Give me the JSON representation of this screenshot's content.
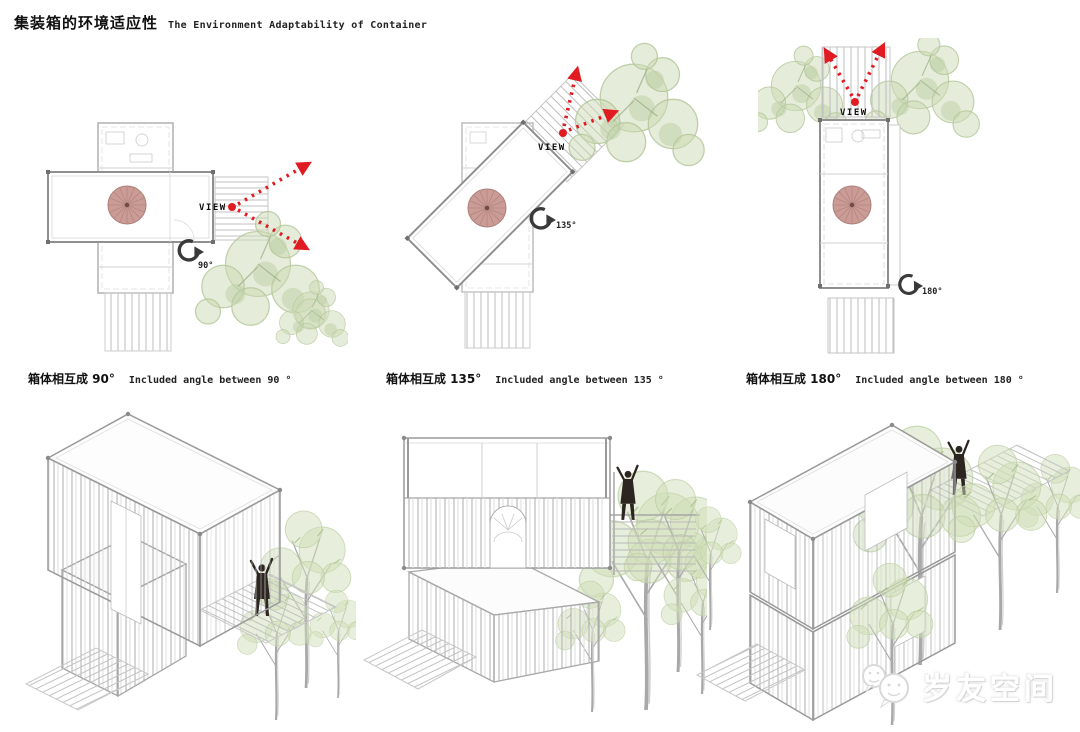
{
  "header": {
    "title_zh": "集装箱的环境适应性",
    "title_en": "The Environment Adaptability of Container"
  },
  "plans": [
    {
      "view_label": "VIEW",
      "angle_label": "90°",
      "caption_zh": "箱体相互成 90°",
      "caption_en": "Included angle between 90 °"
    },
    {
      "view_label": "VIEW",
      "angle_label": "135°",
      "caption_zh": "箱体相互成 135°",
      "caption_en": "Included angle between 135 °"
    },
    {
      "view_label": "VIEW",
      "angle_label": "180°",
      "caption_zh": "箱体相互成 180°",
      "caption_en": "Included angle between 180 °"
    }
  ],
  "watermark": {
    "brand": "岁友空间"
  },
  "colors": {
    "view_arrow_red": "#e11b22",
    "spiral_stair_pink": "#cb9c96",
    "tree_green": "#ccd9b4",
    "figure_dark": "#2c2520",
    "line_gray": "#9a9a9a"
  }
}
